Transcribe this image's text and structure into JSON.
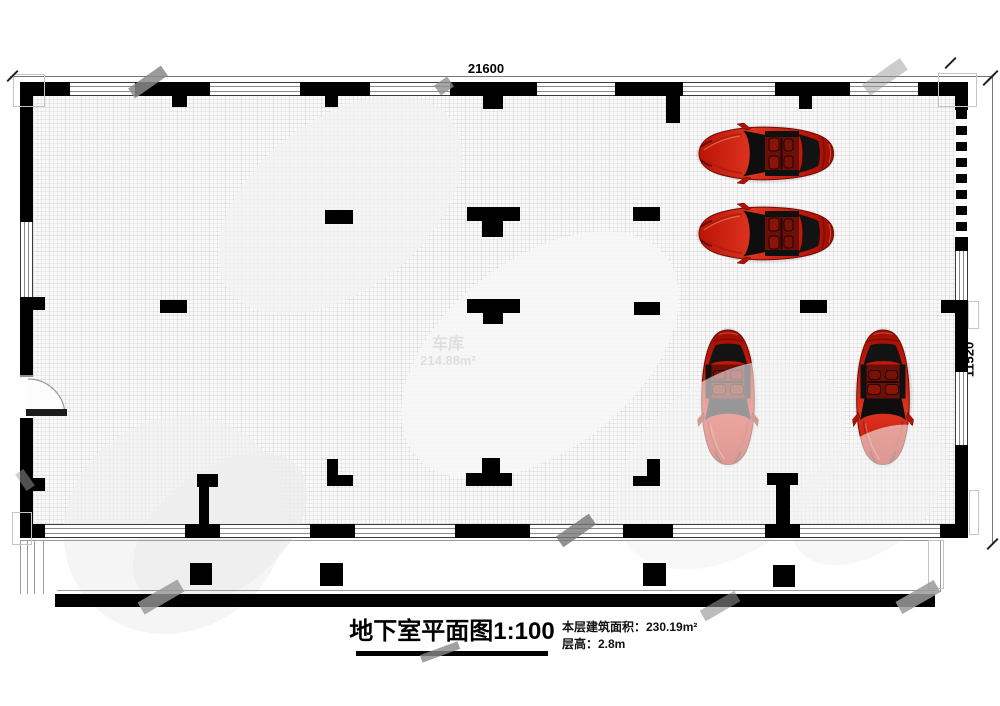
{
  "plan": {
    "room": {
      "name": "车库",
      "area": "214.88m²"
    },
    "dimensions": {
      "width": "21600",
      "height": "11520"
    },
    "cars": {
      "count": 4,
      "body_color": "#c41809",
      "orientations": [
        "horizontal-front-left",
        "horizontal-front-left",
        "vertical-front-down",
        "vertical-front-down"
      ]
    }
  },
  "title_block": {
    "title": "地下室平面图1:100",
    "floor_area_line": "本层建筑面积：230.19m²",
    "floor_height_line": "层高：2.8m"
  },
  "colors": {
    "wall": "#000000",
    "car_red": "#c41809",
    "floor_grid": "#e6e6e6"
  }
}
